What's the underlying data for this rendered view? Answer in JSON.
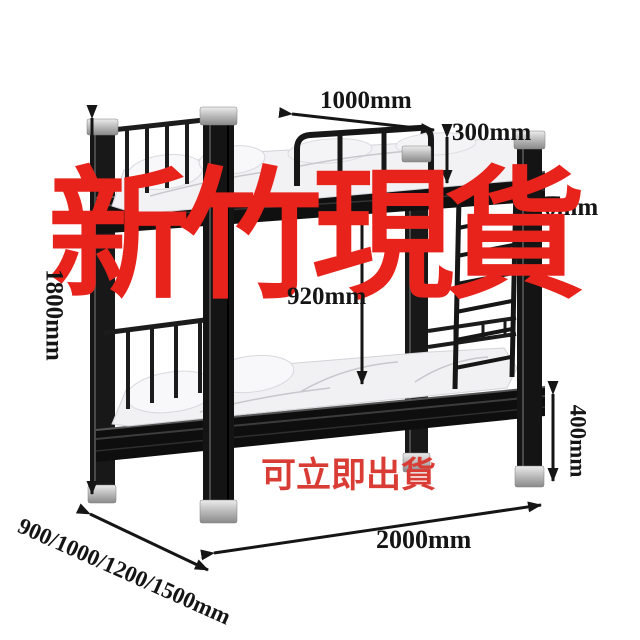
{
  "overlay": {
    "headline": "新竹現貨",
    "headline_color": "#e7231c",
    "footnote": "可立即出貨",
    "footnote_color": "#d93c34"
  },
  "dimensions": {
    "top_rail_length": "1000mm",
    "guardrail_height": "300mm",
    "partial_right_label": "0mm",
    "bunk_clearance": "920mm",
    "overall_height": "1800mm",
    "underbed_leg_height": "400mm",
    "bed_length": "2000mm",
    "bed_width_options": "900/1000/1200/1500mm"
  },
  "figure": {
    "subject": "black metal bunk bed with mattresses and side ladder",
    "frame_color": "#161616",
    "cap_color": "#b9b9b9",
    "mattress_color": "#f2f2f4",
    "background_color": "#ffffff",
    "annotation_color": "#151515"
  }
}
